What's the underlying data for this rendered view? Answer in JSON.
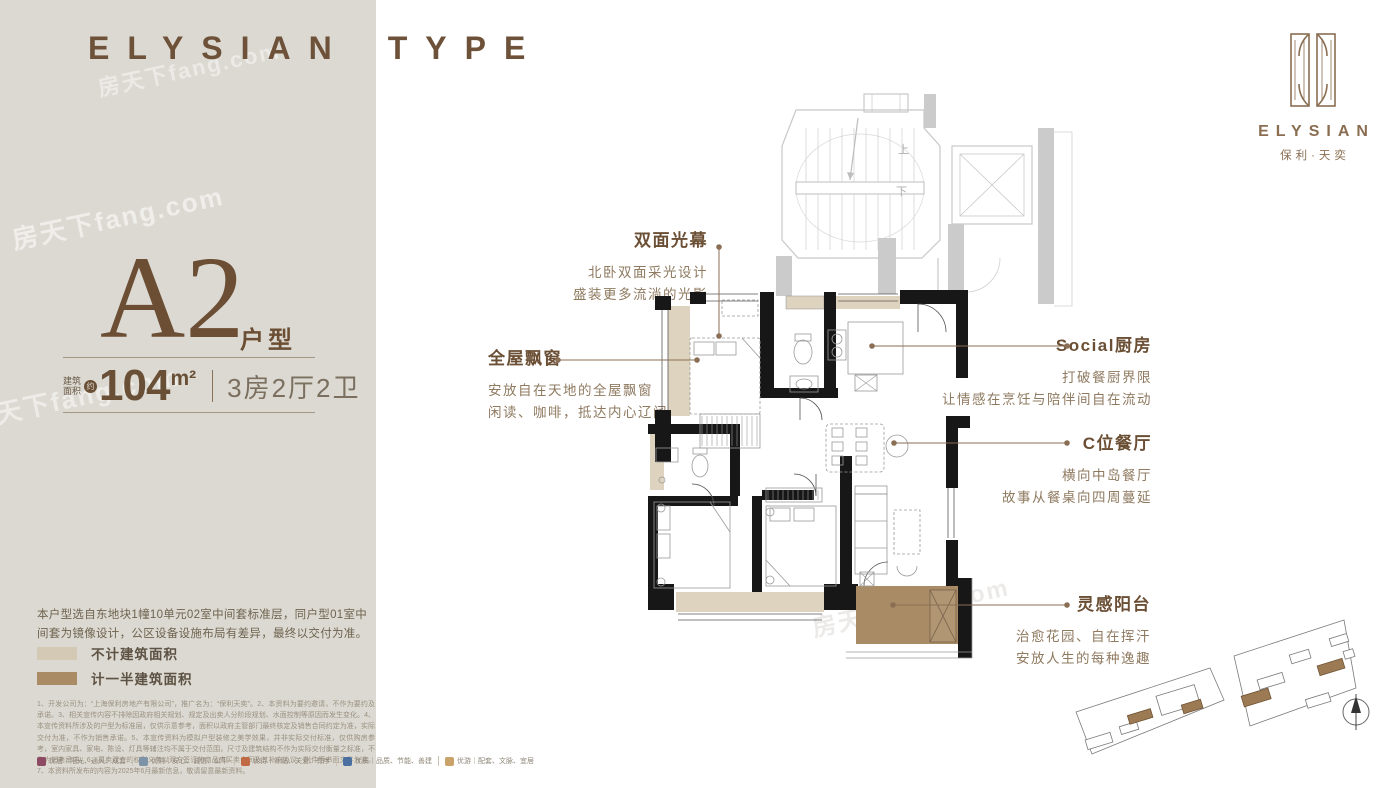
{
  "header": {
    "word1": "ELYSIAN",
    "word2": "TYPE"
  },
  "logo": {
    "name": "ELYSIAN",
    "subtitle": "保利·天奕"
  },
  "unit": {
    "code": "A2",
    "code_suffix": "户型",
    "area_label_line1": "建筑",
    "area_label_line2": "面积",
    "area_approx": "约",
    "area_number": "104",
    "area_unit": "m²",
    "layout": "3房2厅2卫"
  },
  "features": [
    {
      "title": "双面光幕",
      "lines": [
        "北卧双面采光设计",
        "盛装更多流淌的光影"
      ]
    },
    {
      "title": "全屋飘窗",
      "lines": [
        "安放自在天地的全屋飘窗",
        "闲读、咖啡，抵达内心辽阔"
      ]
    },
    {
      "title": "Social厨房",
      "lines": [
        "打破餐厨界限",
        "让情感在烹饪与陪伴间自在流动"
      ]
    },
    {
      "title": "C位餐厅",
      "lines": [
        "横向中岛餐厅",
        "故事从餐桌向四周蔓延"
      ]
    },
    {
      "title": "灵感阳台",
      "lines": [
        "治愈花园、自在挥汗",
        "安放人生的每种逸趣"
      ]
    }
  ],
  "plan": {
    "stairs_up": "上",
    "stairs_down": "下"
  },
  "note": "本户型选自东地块1幢10单元02室中间套标准层，同户型01室中间套为镜像设计，公区设备设施布局有差异，最终以交付为准。",
  "legend": [
    {
      "label": "不计建筑面积",
      "color": "#d4c9b4"
    },
    {
      "label": "计一半建筑面积",
      "color": "#a98c66"
    }
  ],
  "disclaimer": "1、开发公司为：“上海保利房地产有限公司”，推广名为：“保利天奕”。2、本资料为要约邀请，不作为要约及承诺。3、相关宣传内容不排除因政府相关规划、规定及出卖人分阶段规划、水面控制等原因而发生变化。4、本宣传资料所涉及的户型为标准层，仅供示意参考，面积以政府主管部门最终核定及销售合同约定为准，实际交付为准，不作为销售承诺。5、本宣传资料为模拟户型装修之美学效果，并非实际交付标准，仅供购房参考，室内家具、家电、陈设、灯具等辅注均不属于交付范围，尺寸及建筑结构不作为实际交付衡量之标准，不作为销售承诺。6、买卖双方的权利义务以双方签订的商品房买卖合同及其补充协议、附件等书面文件为准。7、本资料所发布的内容为2025年6月最新信息，敬请留意最新资料。",
  "badges": [
    {
      "label": "优居｜阳光、通风、成套",
      "color": "#8e4a63"
    },
    {
      "label": "优购｜安心、诚信、公平",
      "color": "#7d93a8"
    },
    {
      "label": "优待｜补贴、关爱、有序",
      "color": "#c06a45"
    },
    {
      "label": "优质｜品质、节能、善建",
      "color": "#4a6fa0"
    },
    {
      "label": "优游｜配套、文脉、宜居",
      "color": "#c9a36a"
    }
  ],
  "watermark": "房天下fang.com",
  "colors": {
    "accent_brown": "#6b4f35",
    "panel_bg": "#dbd9d1",
    "wall_black": "#171717",
    "bay_window_beige": "#ded3bf",
    "balcony_brown": "#a98c66",
    "core_gray": "#c8c8c8"
  }
}
